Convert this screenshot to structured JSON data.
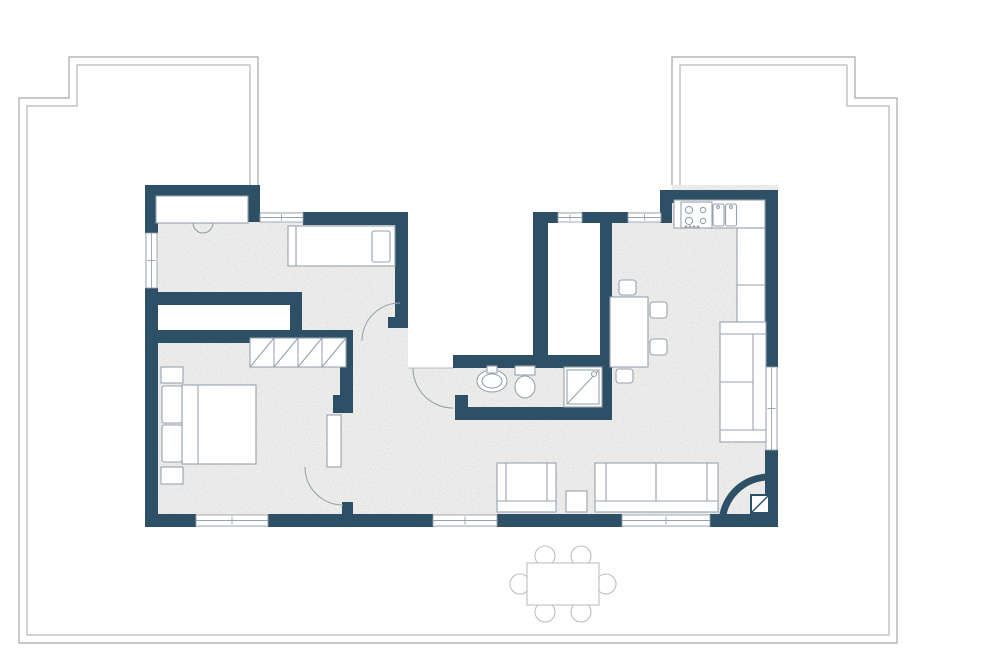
{
  "canvas": {
    "width": 1000,
    "height": 659
  },
  "palette": {
    "wall": "#2d5066",
    "furn": "#96a2ab",
    "line": "#96a2ab",
    "boundary": "#a7a7ab",
    "outdoor": "#bfbfc1",
    "floor": "#f3f2f0",
    "white": "#ffffff",
    "thresh": "#b3bcc2"
  },
  "terrace": {
    "outer_path": "M258,185 L258,57 L69,57 L69,98 L19,98 L19,643 L897,643 L897,98 L855,98 L855,57 L672,57 L672,190",
    "inner_path": "M250,185 L250,65 L77,65 L77,106 L27,106 L27,635 L889,635 L889,106 L847,106 L847,65 L680,65 L680,190",
    "outdoor_chairs": [
      [
        545,
        556
      ],
      [
        581,
        556
      ],
      [
        545,
        612
      ],
      [
        581,
        612
      ],
      [
        520,
        584
      ],
      [
        606,
        584
      ]
    ],
    "outdoor_chair_r": 10,
    "outdoor_table": [
      527,
      563,
      72,
      42
    ]
  },
  "plan": {
    "footprint": [
      145,
      185,
      633,
      342
    ],
    "white_patches": [
      {
        "n": "terrace-gap-left",
        "r": [
          258,
          185,
          154,
          27
        ]
      },
      {
        "n": "terrace-gap-right",
        "r": [
          533,
          185,
          139,
          27
        ]
      },
      {
        "n": "terrace-notch",
        "r": [
          408,
          185,
          129,
          183
        ]
      },
      {
        "n": "storage-room",
        "r": [
          152,
          300,
          142,
          33
        ]
      },
      {
        "n": "shaft-room",
        "r": [
          541,
          218,
          62,
          140
        ]
      }
    ],
    "walls": [
      [
        145,
        185,
        115,
        13
      ],
      [
        246,
        198,
        14,
        24
      ],
      [
        303,
        212,
        105,
        13
      ],
      [
        395,
        212,
        13,
        105
      ],
      [
        388,
        317,
        20,
        11
      ],
      [
        145,
        185,
        13,
        48
      ],
      [
        145,
        288,
        13,
        229
      ],
      [
        145,
        292,
        157,
        13
      ],
      [
        290,
        292,
        12,
        44
      ],
      [
        145,
        330,
        208,
        13
      ],
      [
        340,
        330,
        13,
        70
      ],
      [
        333,
        395,
        20,
        18
      ],
      [
        342,
        502,
        11,
        12
      ],
      [
        533,
        212,
        15,
        156
      ],
      [
        600,
        212,
        12,
        208
      ],
      [
        533,
        212,
        25,
        11
      ],
      [
        582,
        212,
        46,
        11
      ],
      [
        660,
        190,
        12,
        33
      ],
      [
        672,
        190,
        106,
        13
      ],
      [
        765,
        190,
        13,
        177
      ],
      [
        765,
        450,
        13,
        77
      ],
      [
        145,
        514,
        51,
        13
      ],
      [
        268,
        514,
        165,
        13
      ],
      [
        497,
        514,
        125,
        13
      ],
      [
        710,
        514,
        68,
        13
      ],
      [
        453,
        355,
        159,
        13
      ],
      [
        455,
        395,
        13,
        17
      ],
      [
        455,
        407,
        157,
        13
      ]
    ],
    "windows": [
      {
        "n": "window-bottom-bedroom",
        "r": [
          196,
          515,
          72,
          11
        ],
        "o": "h"
      },
      {
        "n": "window-bottom-living-left",
        "r": [
          433,
          515,
          64,
          11
        ],
        "o": "h"
      },
      {
        "n": "window-bottom-living-right",
        "r": [
          622,
          515,
          88,
          11
        ],
        "o": "h"
      },
      {
        "n": "window-top-bedroom",
        "r": [
          260,
          213,
          43,
          9
        ],
        "o": "h"
      },
      {
        "n": "window-top-shaft",
        "r": [
          558,
          213,
          24,
          9
        ],
        "o": "h"
      },
      {
        "n": "window-top-living",
        "r": [
          628,
          213,
          33,
          9
        ],
        "o": "h"
      },
      {
        "n": "window-left-bedroom",
        "r": [
          146,
          233,
          11,
          55
        ],
        "o": "v"
      },
      {
        "n": "window-right-sofa",
        "r": [
          766,
          367,
          11,
          83
        ],
        "o": "v"
      }
    ],
    "furniture": [
      {
        "n": "wardrobe-niche",
        "t": "rect",
        "x": 156,
        "y": 196,
        "w": 92,
        "h": 27,
        "f": "white",
        "s": "furn"
      },
      {
        "n": "niche-door-arc",
        "t": "path",
        "d": "M193,223 A10,10 0 0 0 213,223",
        "s": "furn"
      },
      {
        "n": "single-bed",
        "t": "rect",
        "x": 288,
        "y": 226,
        "w": 107,
        "h": 40,
        "f": "white",
        "s": "furn"
      },
      {
        "n": "single-bed-foot-line",
        "t": "line",
        "x1": 296,
        "y1": 226,
        "x2": 296,
        "y2": 266,
        "s": "furn"
      },
      {
        "n": "single-bed-pillow",
        "t": "rect",
        "x": 372,
        "y": 231,
        "w": 18,
        "h": 31,
        "rx": 2,
        "f": "white",
        "s": "furn"
      },
      {
        "n": "double-bed",
        "t": "rect",
        "x": 182,
        "y": 385,
        "w": 74,
        "h": 79,
        "f": "white",
        "s": "furn"
      },
      {
        "n": "double-bed-head-line",
        "t": "line",
        "x1": 198,
        "y1": 385,
        "x2": 198,
        "y2": 464,
        "s": "furn"
      },
      {
        "n": "bed-pillow",
        "t": "rect",
        "x": 162,
        "y": 386,
        "w": 20,
        "h": 37,
        "rx": 2,
        "f": "white",
        "s": "furn"
      },
      {
        "n": "bed-pillow",
        "t": "rect",
        "x": 162,
        "y": 425,
        "w": 20,
        "h": 37,
        "rx": 2,
        "f": "white",
        "s": "furn"
      },
      {
        "n": "nightstand",
        "t": "rect",
        "x": 161,
        "y": 367,
        "w": 22,
        "h": 16,
        "f": "white",
        "s": "furn"
      },
      {
        "n": "nightstand",
        "t": "rect",
        "x": 161,
        "y": 467,
        "w": 22,
        "h": 17,
        "f": "white",
        "s": "furn"
      },
      {
        "n": "wardrobe",
        "t": "rect",
        "x": 250,
        "y": 338,
        "w": 96,
        "h": 29,
        "f": "white",
        "s": "furn"
      },
      {
        "n": "wardrobe-divider",
        "t": "line",
        "x1": 274,
        "y1": 338,
        "x2": 274,
        "y2": 367,
        "s": "furn"
      },
      {
        "n": "wardrobe-divider",
        "t": "line",
        "x1": 298,
        "y1": 338,
        "x2": 298,
        "y2": 367,
        "s": "furn"
      },
      {
        "n": "wardrobe-divider",
        "t": "line",
        "x1": 322,
        "y1": 338,
        "x2": 322,
        "y2": 367,
        "s": "furn"
      },
      {
        "n": "wardrobe-diagonal",
        "t": "line",
        "x1": 250,
        "y1": 367,
        "x2": 274,
        "y2": 338,
        "s": "furn"
      },
      {
        "n": "wardrobe-diagonal",
        "t": "line",
        "x1": 274,
        "y1": 367,
        "x2": 298,
        "y2": 338,
        "s": "furn"
      },
      {
        "n": "wardrobe-diagonal",
        "t": "line",
        "x1": 298,
        "y1": 367,
        "x2": 322,
        "y2": 338,
        "s": "furn"
      },
      {
        "n": "wardrobe-diagonal",
        "t": "line",
        "x1": 322,
        "y1": 367,
        "x2": 346,
        "y2": 338,
        "s": "furn"
      },
      {
        "n": "door-leaf-master",
        "t": "rect",
        "x": 327,
        "y": 415,
        "w": 14,
        "h": 52,
        "f": "white",
        "s": "furn"
      },
      {
        "n": "door-arc-master",
        "t": "path",
        "d": "M305,467 A38,38 0 0 0 343,505",
        "s": "furn"
      },
      {
        "n": "door-arc-bedroom",
        "t": "path",
        "d": "M362,341 A38,38 0 0 1 400,303",
        "s": "furn"
      },
      {
        "n": "door-arc-bathroom",
        "t": "path",
        "d": "M413,368 A40,40 0 0 0 453,408",
        "s": "furn"
      },
      {
        "n": "threshold-line",
        "t": "line",
        "x1": 408,
        "y1": 368,
        "x2": 453,
        "y2": 368,
        "s": "thresh"
      },
      {
        "n": "bathroom-sink",
        "t": "ellipse",
        "cx": 492,
        "cy": 381,
        "rx": 15,
        "ry": 11,
        "f": "white",
        "s": "furn"
      },
      {
        "n": "bathroom-sink-basin",
        "t": "ellipse",
        "cx": 492,
        "cy": 381,
        "rx": 10,
        "ry": 7,
        "f": "white",
        "s": "furn"
      },
      {
        "n": "bathroom-tap",
        "t": "rect",
        "x": 487,
        "y": 366,
        "w": 10,
        "h": 7,
        "f": "white",
        "s": "furn"
      },
      {
        "n": "toilet-tank",
        "t": "rect",
        "x": 515,
        "y": 366,
        "w": 20,
        "h": 9,
        "f": "white",
        "s": "furn"
      },
      {
        "n": "toilet-bowl",
        "t": "ellipse",
        "cx": 525,
        "cy": 387,
        "rx": 10,
        "ry": 11,
        "f": "white",
        "s": "furn"
      },
      {
        "n": "shower",
        "t": "rect",
        "x": 564,
        "y": 367,
        "w": 38,
        "h": 40,
        "f": "white",
        "s": "furn"
      },
      {
        "n": "shower-inner",
        "t": "rect",
        "x": 567,
        "y": 370,
        "w": 32,
        "h": 34,
        "f": "white",
        "s": "furn"
      },
      {
        "n": "shower-diagonal",
        "t": "line",
        "x1": 568,
        "y1": 403,
        "x2": 598,
        "y2": 371,
        "s": "furn"
      },
      {
        "n": "shower-head",
        "t": "circle",
        "cx": 594,
        "cy": 374,
        "r": 2.5,
        "f": "white",
        "s": "furn"
      },
      {
        "n": "kitchen-counter-top",
        "t": "rect",
        "x": 674,
        "y": 200,
        "w": 91,
        "h": 28,
        "f": "white",
        "s": "furn"
      },
      {
        "n": "kitchen-counter-side",
        "t": "rect",
        "x": 737,
        "y": 228,
        "w": 28,
        "h": 139,
        "f": "white",
        "s": "furn"
      },
      {
        "n": "counter-divider",
        "t": "line",
        "x1": 737,
        "y1": 285,
        "x2": 765,
        "y2": 285,
        "s": "furn"
      },
      {
        "n": "counter-divider",
        "t": "line",
        "x1": 737,
        "y1": 322,
        "x2": 765,
        "y2": 322,
        "s": "furn"
      },
      {
        "n": "stove",
        "t": "rect",
        "x": 681,
        "y": 202,
        "w": 31,
        "h": 26,
        "f": "white",
        "s": "furn"
      },
      {
        "n": "stove-burner",
        "t": "circle",
        "cx": 689,
        "cy": 210,
        "r": 3.6,
        "f": "white",
        "s": "furn"
      },
      {
        "n": "stove-burner",
        "t": "circle",
        "cx": 703,
        "cy": 210,
        "r": 2.7,
        "f": "white",
        "s": "furn"
      },
      {
        "n": "stove-burner",
        "t": "circle",
        "cx": 689,
        "cy": 221,
        "r": 3.6,
        "f": "white",
        "s": "furn"
      },
      {
        "n": "stove-burner",
        "t": "circle",
        "cx": 703,
        "cy": 221,
        "r": 2.7,
        "f": "white",
        "s": "furn"
      },
      {
        "n": "stove-knob",
        "t": "circle",
        "cx": 686,
        "cy": 227,
        "r": 0.9,
        "f": "furn",
        "s": "furn"
      },
      {
        "n": "stove-knob",
        "t": "circle",
        "cx": 690,
        "cy": 227,
        "r": 0.9,
        "f": "furn",
        "s": "furn"
      },
      {
        "n": "stove-knob",
        "t": "circle",
        "cx": 694,
        "cy": 227,
        "r": 0.9,
        "f": "furn",
        "s": "furn"
      },
      {
        "n": "stove-knob",
        "t": "circle",
        "cx": 698,
        "cy": 227,
        "r": 0.9,
        "f": "furn",
        "s": "furn"
      },
      {
        "n": "kitchen-sink",
        "t": "rect",
        "x": 713,
        "y": 204,
        "w": 11,
        "h": 22,
        "rx": 2,
        "f": "white",
        "s": "furn"
      },
      {
        "n": "kitchen-sink",
        "t": "rect",
        "x": 725.5,
        "y": 204,
        "w": 11,
        "h": 22,
        "rx": 2,
        "f": "white",
        "s": "furn"
      },
      {
        "n": "sink-faucet",
        "t": "circle",
        "cx": 718,
        "cy": 207,
        "r": 1.4,
        "f": "white",
        "s": "furn"
      },
      {
        "n": "sink-faucet",
        "t": "circle",
        "cx": 731,
        "cy": 207,
        "r": 1.4,
        "f": "white",
        "s": "furn"
      },
      {
        "n": "dining-table",
        "t": "rect",
        "x": 610,
        "y": 297,
        "w": 38,
        "h": 70,
        "f": "white",
        "s": "furn"
      },
      {
        "n": "dining-chair",
        "t": "rect",
        "x": 619,
        "y": 280,
        "w": 17,
        "h": 15,
        "rx": 3,
        "f": "white",
        "s": "furn"
      },
      {
        "n": "dining-chair",
        "t": "rect",
        "x": 650,
        "y": 302,
        "w": 17,
        "h": 16,
        "rx": 3,
        "f": "white",
        "s": "furn"
      },
      {
        "n": "dining-chair",
        "t": "rect",
        "x": 650,
        "y": 339,
        "w": 17,
        "h": 16,
        "rx": 3,
        "f": "white",
        "s": "furn"
      },
      {
        "n": "dining-chair",
        "t": "rect",
        "x": 616,
        "y": 369,
        "w": 17,
        "h": 14,
        "rx": 3,
        "f": "white",
        "s": "furn"
      },
      {
        "n": "sofa-right",
        "t": "rect",
        "x": 720,
        "y": 322,
        "w": 46,
        "h": 120,
        "f": "white",
        "s": "furn"
      },
      {
        "n": "sofa-right-armrest",
        "t": "line",
        "x1": 720,
        "y1": 334,
        "x2": 766,
        "y2": 334,
        "s": "furn"
      },
      {
        "n": "sofa-right-armrest",
        "t": "line",
        "x1": 720,
        "y1": 430,
        "x2": 766,
        "y2": 430,
        "s": "furn"
      },
      {
        "n": "sofa-right-backrest",
        "t": "line",
        "x1": 753,
        "y1": 334,
        "x2": 753,
        "y2": 430,
        "s": "furn"
      },
      {
        "n": "sofa-right-cushion",
        "t": "line",
        "x1": 720,
        "y1": 382,
        "x2": 753,
        "y2": 382,
        "s": "furn"
      },
      {
        "n": "sofa-bottom",
        "t": "rect",
        "x": 595,
        "y": 463,
        "w": 123,
        "h": 49,
        "f": "white",
        "s": "furn"
      },
      {
        "n": "sofa-bottom-backrest",
        "t": "line",
        "x1": 595,
        "y1": 501,
        "x2": 718,
        "y2": 501,
        "s": "furn"
      },
      {
        "n": "sofa-bottom-armrest",
        "t": "line",
        "x1": 606,
        "y1": 463,
        "x2": 606,
        "y2": 501,
        "s": "furn"
      },
      {
        "n": "sofa-bottom-armrest",
        "t": "line",
        "x1": 707,
        "y1": 463,
        "x2": 707,
        "y2": 501,
        "s": "furn"
      },
      {
        "n": "sofa-bottom-cushion",
        "t": "line",
        "x1": 656,
        "y1": 463,
        "x2": 656,
        "y2": 501,
        "s": "furn"
      },
      {
        "n": "loveseat",
        "t": "rect",
        "x": 497,
        "y": 463,
        "w": 59,
        "h": 49,
        "f": "white",
        "s": "furn"
      },
      {
        "n": "loveseat-backrest",
        "t": "line",
        "x1": 497,
        "y1": 501,
        "x2": 556,
        "y2": 501,
        "s": "furn"
      },
      {
        "n": "loveseat-armrest",
        "t": "line",
        "x1": 506,
        "y1": 463,
        "x2": 506,
        "y2": 501,
        "s": "furn"
      },
      {
        "n": "loveseat-armrest",
        "t": "line",
        "x1": 547,
        "y1": 463,
        "x2": 547,
        "y2": 501,
        "s": "furn"
      },
      {
        "n": "side-table",
        "t": "rect",
        "x": 566,
        "y": 491,
        "w": 21,
        "h": 21,
        "f": "white",
        "s": "furn"
      },
      {
        "n": "entry-door-arc",
        "t": "path",
        "d": "M722,524 A47,47 0 0 1 769,477",
        "s": "wall",
        "sw": 7
      },
      {
        "n": "entry-tile",
        "t": "rect",
        "x": 751,
        "y": 495,
        "w": 18,
        "h": 18,
        "f": "white",
        "s": "wall",
        "sw": 2
      },
      {
        "n": "entry-tile-diagonal",
        "t": "line",
        "x1": 752,
        "y1": 512,
        "x2": 768,
        "y2": 496,
        "s": "wall",
        "sw": 1.5
      }
    ]
  }
}
